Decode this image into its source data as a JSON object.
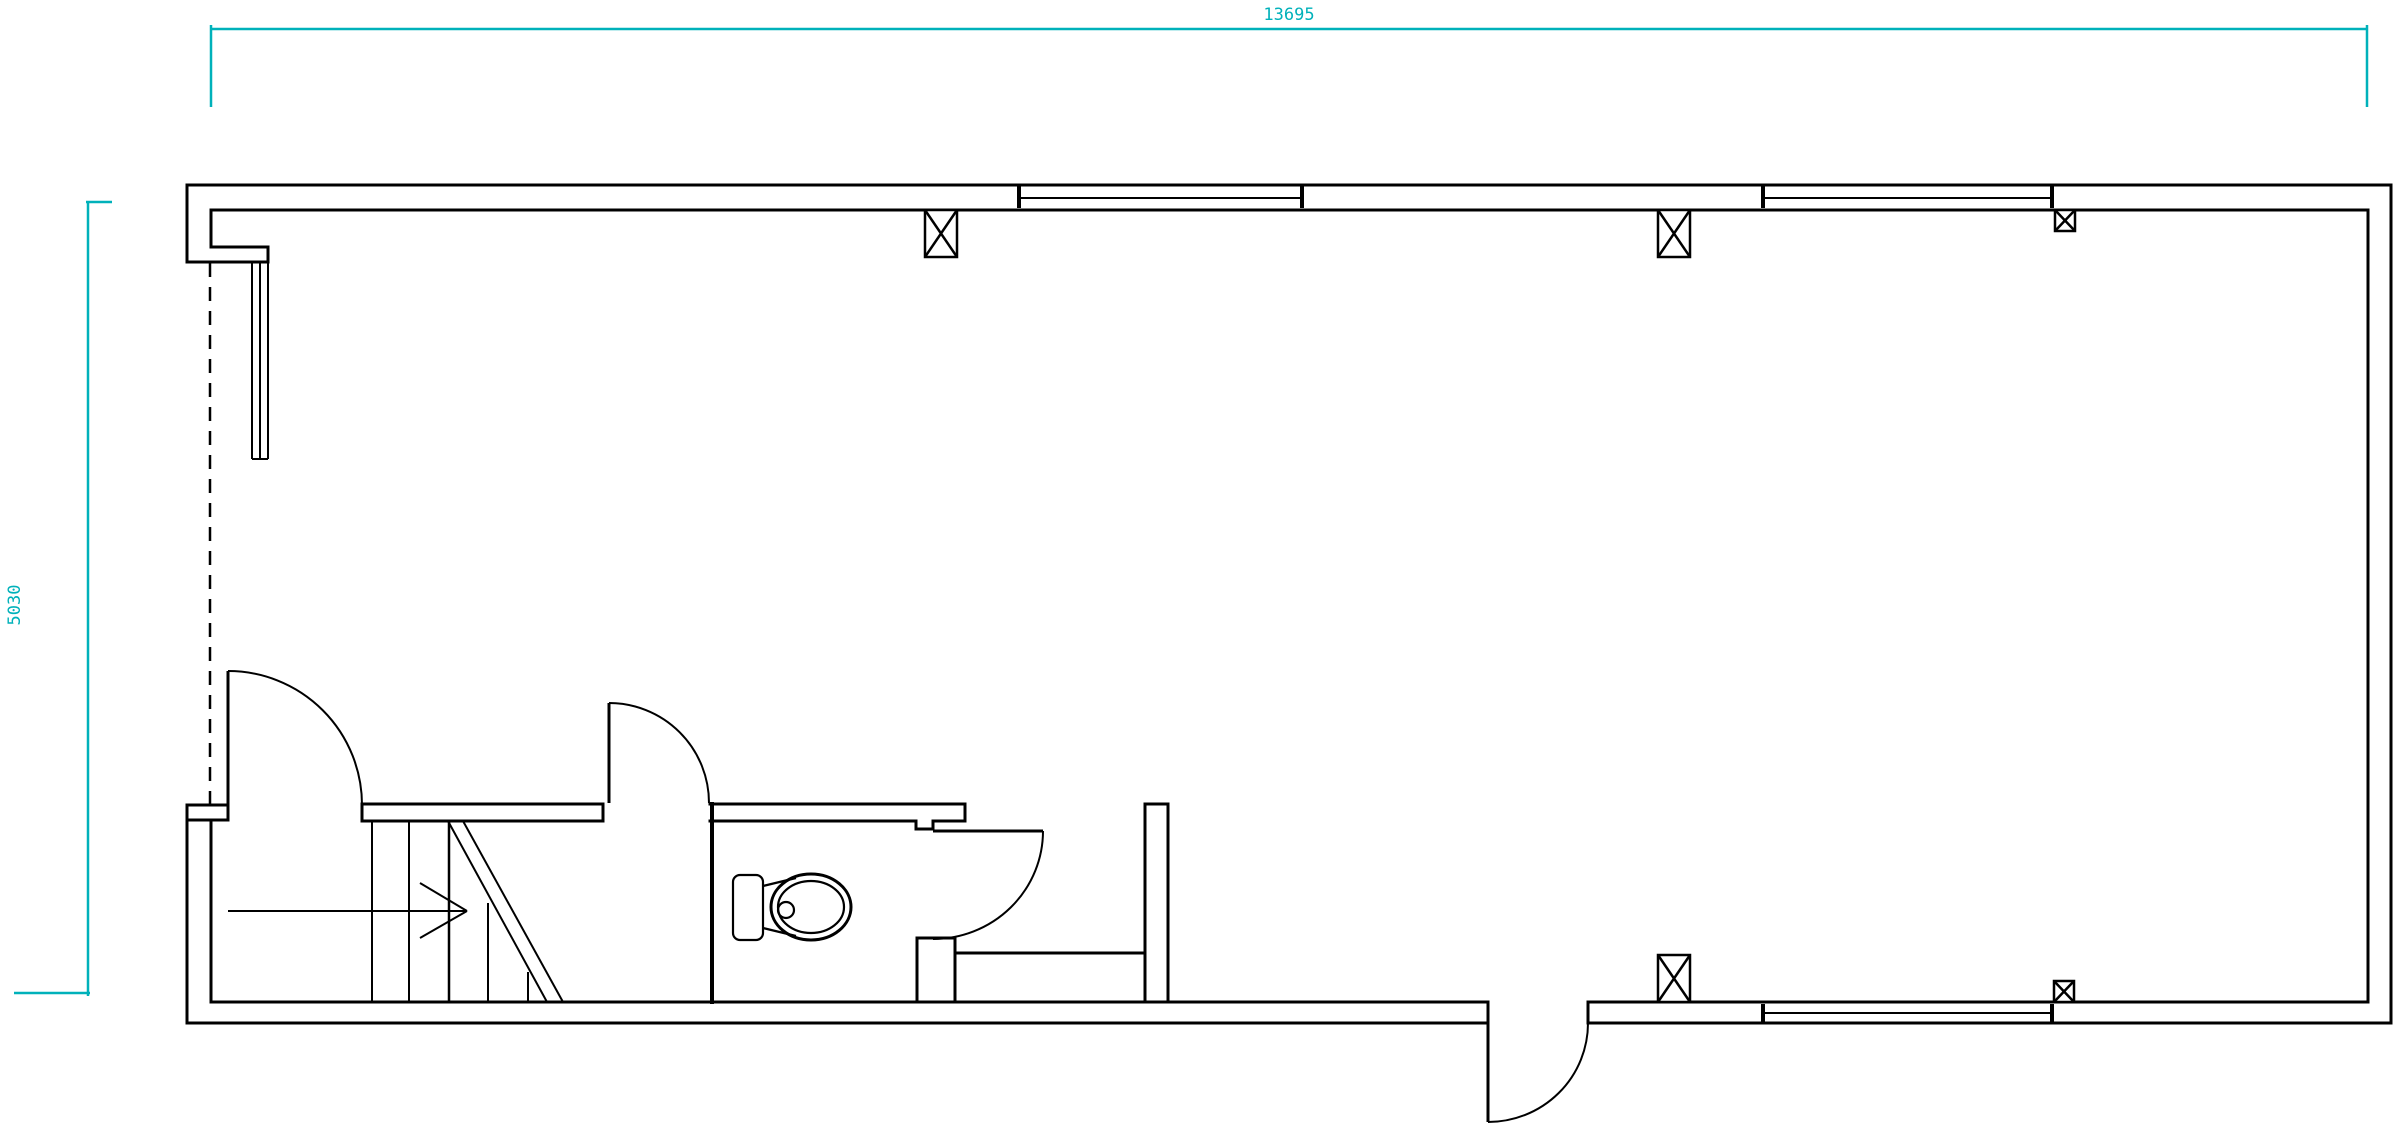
{
  "drawing": {
    "canvas": {
      "width": 2404,
      "height": 1136,
      "background": "#ffffff"
    },
    "colors": {
      "wall": "#000000",
      "dimension": "#00b1ba"
    },
    "dimensions": {
      "top": {
        "label": "13695",
        "x": 1289,
        "y": 20,
        "rotate": 0
      },
      "left": {
        "label": "5030",
        "x": 20,
        "y": 605,
        "rotate": -90
      }
    },
    "layers": [
      {
        "name": "dimension-lines",
        "stroke": "#00b1ba",
        "width": 2.5,
        "cap": "butt",
        "prims": [
          {
            "t": "line",
            "p": [
              211,
              29,
              2367,
              29
            ]
          },
          {
            "t": "line",
            "p": [
              211,
              25,
              211,
              107
            ]
          },
          {
            "t": "line",
            "p": [
              2367,
              25,
              2367,
              107
            ]
          },
          {
            "t": "line",
            "p": [
              88,
              202,
              88,
              996
            ]
          },
          {
            "t": "line",
            "p": [
              86,
              202,
              112,
              202
            ]
          },
          {
            "t": "line",
            "p": [
              14,
              993,
              90,
              993
            ]
          }
        ]
      },
      {
        "name": "exterior-walls",
        "stroke": "#000000",
        "width": 3,
        "cap": "square",
        "prims": [
          {
            "t": "line",
            "p": [
              187,
              185,
              2391,
              185
            ]
          },
          {
            "t": "line",
            "p": [
              2391,
              185,
              2391,
              1023
            ]
          },
          {
            "t": "line",
            "p": [
              2391,
              1023,
              1588,
              1023
            ]
          },
          {
            "t": "line",
            "p": [
              1488,
              1023,
              187,
              1023
            ]
          },
          {
            "t": "line",
            "p": [
              187,
              1023,
              187,
              805
            ]
          },
          {
            "t": "line",
            "p": [
              187,
              262,
              187,
              185
            ]
          },
          {
            "t": "line",
            "p": [
              211,
              210,
              2368,
              210
            ]
          },
          {
            "t": "line",
            "p": [
              2368,
              210,
              2368,
              1002
            ]
          },
          {
            "t": "line",
            "p": [
              2368,
              1002,
              1588,
              1002
            ]
          },
          {
            "t": "line",
            "p": [
              1488,
              1002,
              211,
              1002
            ]
          },
          {
            "t": "line",
            "p": [
              211,
              1002,
              211,
              820
            ]
          },
          {
            "t": "line",
            "p": [
              211,
              210,
              211,
              247
            ]
          },
          {
            "t": "line",
            "p": [
              211,
              247,
              268,
              247
            ]
          },
          {
            "t": "line",
            "p": [
              268,
              247,
              268,
              262
            ]
          },
          {
            "t": "line",
            "p": [
              187,
              262,
              268,
              262
            ]
          },
          {
            "t": "line",
            "p": [
              1588,
              1002,
              1588,
              1023
            ]
          }
        ]
      },
      {
        "name": "left-entry-mullion",
        "stroke": "#000000",
        "width": 2,
        "cap": "butt",
        "prims": [
          {
            "t": "line",
            "p": [
              252,
              263,
              252,
              459
            ]
          },
          {
            "t": "line",
            "p": [
              260,
              263,
              260,
              459
            ]
          },
          {
            "t": "line",
            "p": [
              268,
              263,
              268,
              459
            ]
          },
          {
            "t": "line",
            "p": [
              252,
              459,
              268,
              459
            ]
          }
        ]
      },
      {
        "name": "opening-dashed",
        "stroke": "#000000",
        "width": 2.5,
        "cap": "butt",
        "dash": "14 10",
        "prims": [
          {
            "t": "line",
            "p": [
              210,
              263,
              210,
              805
            ]
          }
        ]
      },
      {
        "name": "interior-walls",
        "stroke": "#000000",
        "width": 3,
        "cap": "square",
        "prims": [
          {
            "t": "rect",
            "p": [
              187,
              805,
              41,
              15
            ]
          },
          {
            "t": "line",
            "p": [
              362,
              804,
              603,
              804
            ]
          },
          {
            "t": "line",
            "p": [
              362,
              821,
              603,
              821
            ]
          },
          {
            "t": "line",
            "p": [
              362,
              804,
              362,
              821
            ]
          },
          {
            "t": "line",
            "p": [
              603,
              804,
              603,
              821
            ]
          },
          {
            "t": "line",
            "p": [
              710,
              804,
              965,
              804
            ]
          },
          {
            "t": "line",
            "p": [
              710,
              821,
              916,
              821
            ]
          },
          {
            "t": "line",
            "p": [
              916,
              821,
              916,
              829
            ]
          },
          {
            "t": "line",
            "p": [
              916,
              829,
              933,
              829
            ]
          },
          {
            "t": "line",
            "p": [
              933,
              829,
              933,
              821
            ]
          },
          {
            "t": "line",
            "p": [
              933,
              821,
              965,
              821
            ]
          },
          {
            "t": "line",
            "p": [
              965,
              804,
              965,
              821
            ]
          },
          {
            "t": "line",
            "p": [
              712,
              804,
              712,
              1002
            ],
            "w": 4
          },
          {
            "t": "rect",
            "p": [
              917,
              938,
              38,
              64
            ]
          },
          {
            "t": "rect",
            "p": [
              955,
              953,
              190,
              49
            ]
          },
          {
            "t": "rect",
            "p": [
              1145,
              804,
              23,
              198
            ]
          }
        ]
      },
      {
        "name": "windows",
        "stroke": "#000000",
        "width": 2,
        "cap": "butt",
        "prims": [
          {
            "t": "line",
            "p": [
              1019,
              198,
              1302,
              198
            ]
          },
          {
            "t": "line",
            "p": [
              1019,
              185,
              1019,
              208
            ],
            "w": 4
          },
          {
            "t": "line",
            "p": [
              1302,
              185,
              1302,
              208
            ],
            "w": 4
          },
          {
            "t": "line",
            "p": [
              1763,
              198,
              2052,
              198
            ]
          },
          {
            "t": "line",
            "p": [
              1763,
              185,
              1763,
              208
            ],
            "w": 4
          },
          {
            "t": "line",
            "p": [
              2052,
              185,
              2052,
              208
            ],
            "w": 4
          },
          {
            "t": "line",
            "p": [
              1763,
              1013,
              2052,
              1013
            ]
          },
          {
            "t": "line",
            "p": [
              1763,
              1004,
              1763,
              1023
            ],
            "w": 4
          },
          {
            "t": "line",
            "p": [
              2052,
              1004,
              2052,
              1023
            ],
            "w": 4
          }
        ]
      },
      {
        "name": "columns",
        "stroke": "#000000",
        "width": 2.5,
        "cap": "butt",
        "prims": [
          {
            "t": "rect",
            "p": [
              925,
              210,
              32,
              47
            ]
          },
          {
            "t": "line",
            "p": [
              925,
              210,
              957,
              257
            ]
          },
          {
            "t": "line",
            "p": [
              957,
              210,
              925,
              257
            ]
          },
          {
            "t": "rect",
            "p": [
              1658,
              210,
              32,
              47
            ]
          },
          {
            "t": "line",
            "p": [
              1658,
              210,
              1690,
              257
            ]
          },
          {
            "t": "line",
            "p": [
              1690,
              210,
              1658,
              257
            ]
          },
          {
            "t": "rect",
            "p": [
              1658,
              955,
              32,
              47
            ]
          },
          {
            "t": "line",
            "p": [
              1658,
              955,
              1690,
              1002
            ]
          },
          {
            "t": "line",
            "p": [
              1690,
              955,
              1658,
              1002
            ]
          },
          {
            "t": "rect",
            "p": [
              2055,
              210,
              20,
              21
            ]
          },
          {
            "t": "line",
            "p": [
              2055,
              210,
              2075,
              231
            ]
          },
          {
            "t": "line",
            "p": [
              2075,
              210,
              2055,
              231
            ]
          },
          {
            "t": "rect",
            "p": [
              2054,
              981,
              20,
              21
            ]
          },
          {
            "t": "line",
            "p": [
              2054,
              981,
              2074,
              1002
            ]
          },
          {
            "t": "line",
            "p": [
              2074,
              981,
              2054,
              1002
            ]
          }
        ]
      },
      {
        "name": "doors",
        "stroke": "#000000",
        "width": 2,
        "cap": "butt",
        "prims": [
          {
            "t": "line",
            "p": [
              228,
              671,
              228,
              805
            ],
            "w": 3
          },
          {
            "t": "path",
            "d": "M 228 671 A 134 134 0 0 1 362 805"
          },
          {
            "t": "line",
            "p": [
              609,
              703,
              609,
              803
            ],
            "w": 3
          },
          {
            "t": "path",
            "d": "M 609 703 A 100 100 0 0 1 709 803"
          },
          {
            "t": "line",
            "p": [
              933,
              831,
              1043,
              831
            ],
            "w": 3
          },
          {
            "t": "path",
            "d": "M 1043 831 A 110 108 0 0 1 933 939"
          },
          {
            "t": "line",
            "p": [
              1488,
              1002,
              1488,
              1122
            ],
            "w": 3
          },
          {
            "t": "path",
            "d": "M 1488 1122 A 100 99 0 0 0 1588 1023"
          }
        ]
      },
      {
        "name": "stairs",
        "stroke": "#000000",
        "width": 2,
        "cap": "butt",
        "prims": [
          {
            "t": "line",
            "p": [
              372,
              821,
              372,
              1002
            ]
          },
          {
            "t": "line",
            "p": [
              409,
              821,
              409,
              1002
            ]
          },
          {
            "t": "line",
            "p": [
              449,
              821,
              449,
              1002
            ],
            "w": 2.5
          },
          {
            "t": "line",
            "p": [
              488,
              903,
              488,
              1002
            ]
          },
          {
            "t": "line",
            "p": [
              528,
              972,
              528,
              1002
            ]
          },
          {
            "t": "line",
            "p": [
              448,
              821,
              547,
              1002
            ]
          },
          {
            "t": "line",
            "p": [
              463,
              821,
              563,
              1002
            ]
          },
          {
            "t": "line",
            "p": [
              228,
              911,
              467,
              911
            ]
          },
          {
            "t": "line",
            "p": [
              420,
              883,
              467,
              911
            ]
          },
          {
            "t": "line",
            "p": [
              420,
              938,
              467,
              911
            ]
          }
        ]
      },
      {
        "name": "toilet-fixture",
        "stroke": "#000000",
        "width": 2.2,
        "cap": "butt",
        "prims": [
          {
            "t": "rrect",
            "p": [
              733,
              875,
              30,
              65,
              7
            ]
          },
          {
            "t": "ellipse",
            "p": [
              811,
              907,
              40,
              33
            ],
            "w": 3
          },
          {
            "t": "ellipse",
            "p": [
              811,
              907,
              33,
              26
            ]
          },
          {
            "t": "circle",
            "p": [
              786,
              910,
              8
            ]
          },
          {
            "t": "line",
            "p": [
              763,
              886,
              796,
              878
            ]
          },
          {
            "t": "line",
            "p": [
              763,
              928,
              796,
              936
            ]
          }
        ]
      }
    ]
  }
}
